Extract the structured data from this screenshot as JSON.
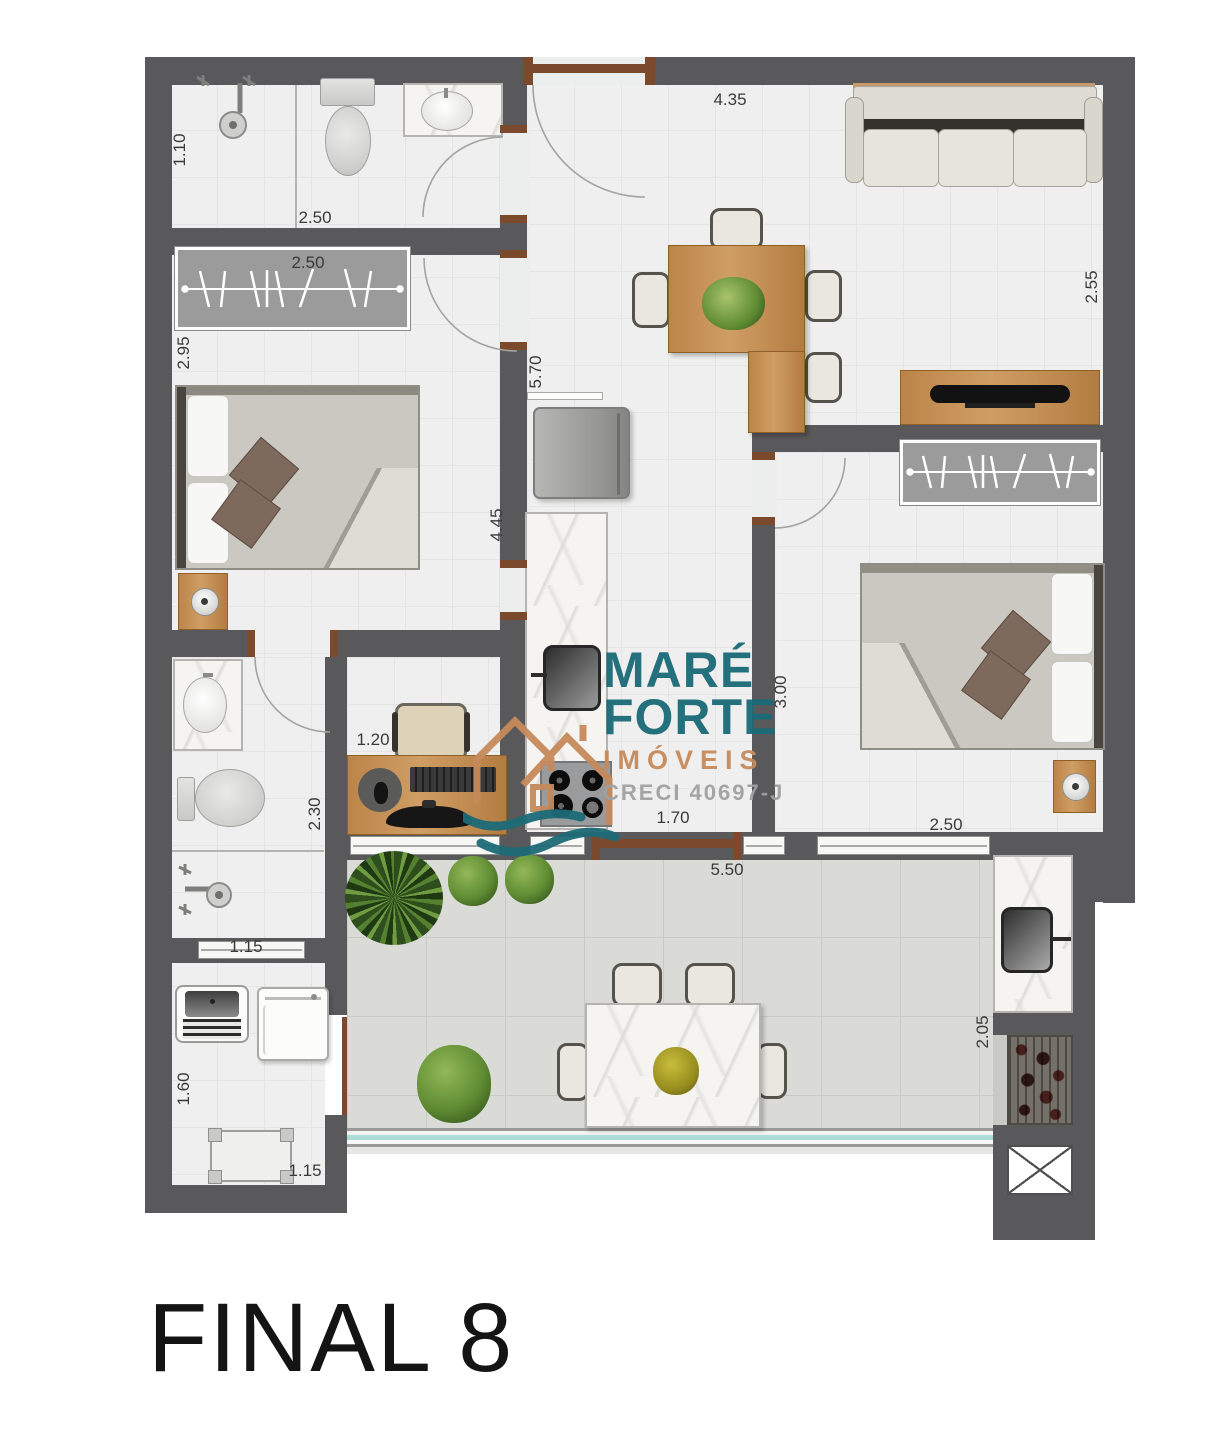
{
  "title": "FINAL 8",
  "watermark": {
    "name_line1": "MARÉ",
    "name_line2": "FORTE",
    "segment": "IMÓVEIS",
    "license": "CRECI 40697-J",
    "teal": "#1b6a78",
    "tan": "#c68a5c",
    "gray": "#a0a0a0"
  },
  "colors": {
    "wall": "#59585a",
    "wood": "#c0894f",
    "interior_floor": "#eeefee",
    "balcony_floor": "#dadbd7",
    "marble": "#f5f4f1",
    "door_frame": "#7b4a2c",
    "railing_glass": "#aedbd6"
  },
  "dimensions_m": [
    {
      "label": "1.10",
      "x": 35,
      "y": 95,
      "rot": -90
    },
    {
      "label": "2.50",
      "x": 170,
      "y": 163,
      "rot": 0
    },
    {
      "label": "2.50",
      "x": 163,
      "y": 208,
      "rot": 0
    },
    {
      "label": "2.95",
      "x": 39,
      "y": 298,
      "rot": -90
    },
    {
      "label": "4.35",
      "x": 585,
      "y": 45,
      "rot": 0
    },
    {
      "label": "2.55",
      "x": 947,
      "y": 232,
      "rot": -90
    },
    {
      "label": "5.70",
      "x": 391,
      "y": 317,
      "rot": -90
    },
    {
      "label": "4.45",
      "x": 352,
      "y": 470,
      "rot": -90
    },
    {
      "label": "3.00",
      "x": 636,
      "y": 637,
      "rot": -90
    },
    {
      "label": "1.20",
      "x": 228,
      "y": 685,
      "rot": 0
    },
    {
      "label": "2.30",
      "x": 170,
      "y": 759,
      "rot": -90
    },
    {
      "label": "1.15",
      "x": 101,
      "y": 892,
      "rot": 0
    },
    {
      "label": "1.70",
      "x": 528,
      "y": 763,
      "rot": 0
    },
    {
      "label": "2.50",
      "x": 801,
      "y": 770,
      "rot": 0
    },
    {
      "label": "5.50",
      "x": 582,
      "y": 815,
      "rot": 0
    },
    {
      "label": "1.60",
      "x": 39,
      "y": 1034,
      "rot": -90
    },
    {
      "label": "1.15",
      "x": 160,
      "y": 1116,
      "rot": 0
    },
    {
      "label": "2.05",
      "x": 838,
      "y": 977,
      "rot": -90
    }
  ]
}
